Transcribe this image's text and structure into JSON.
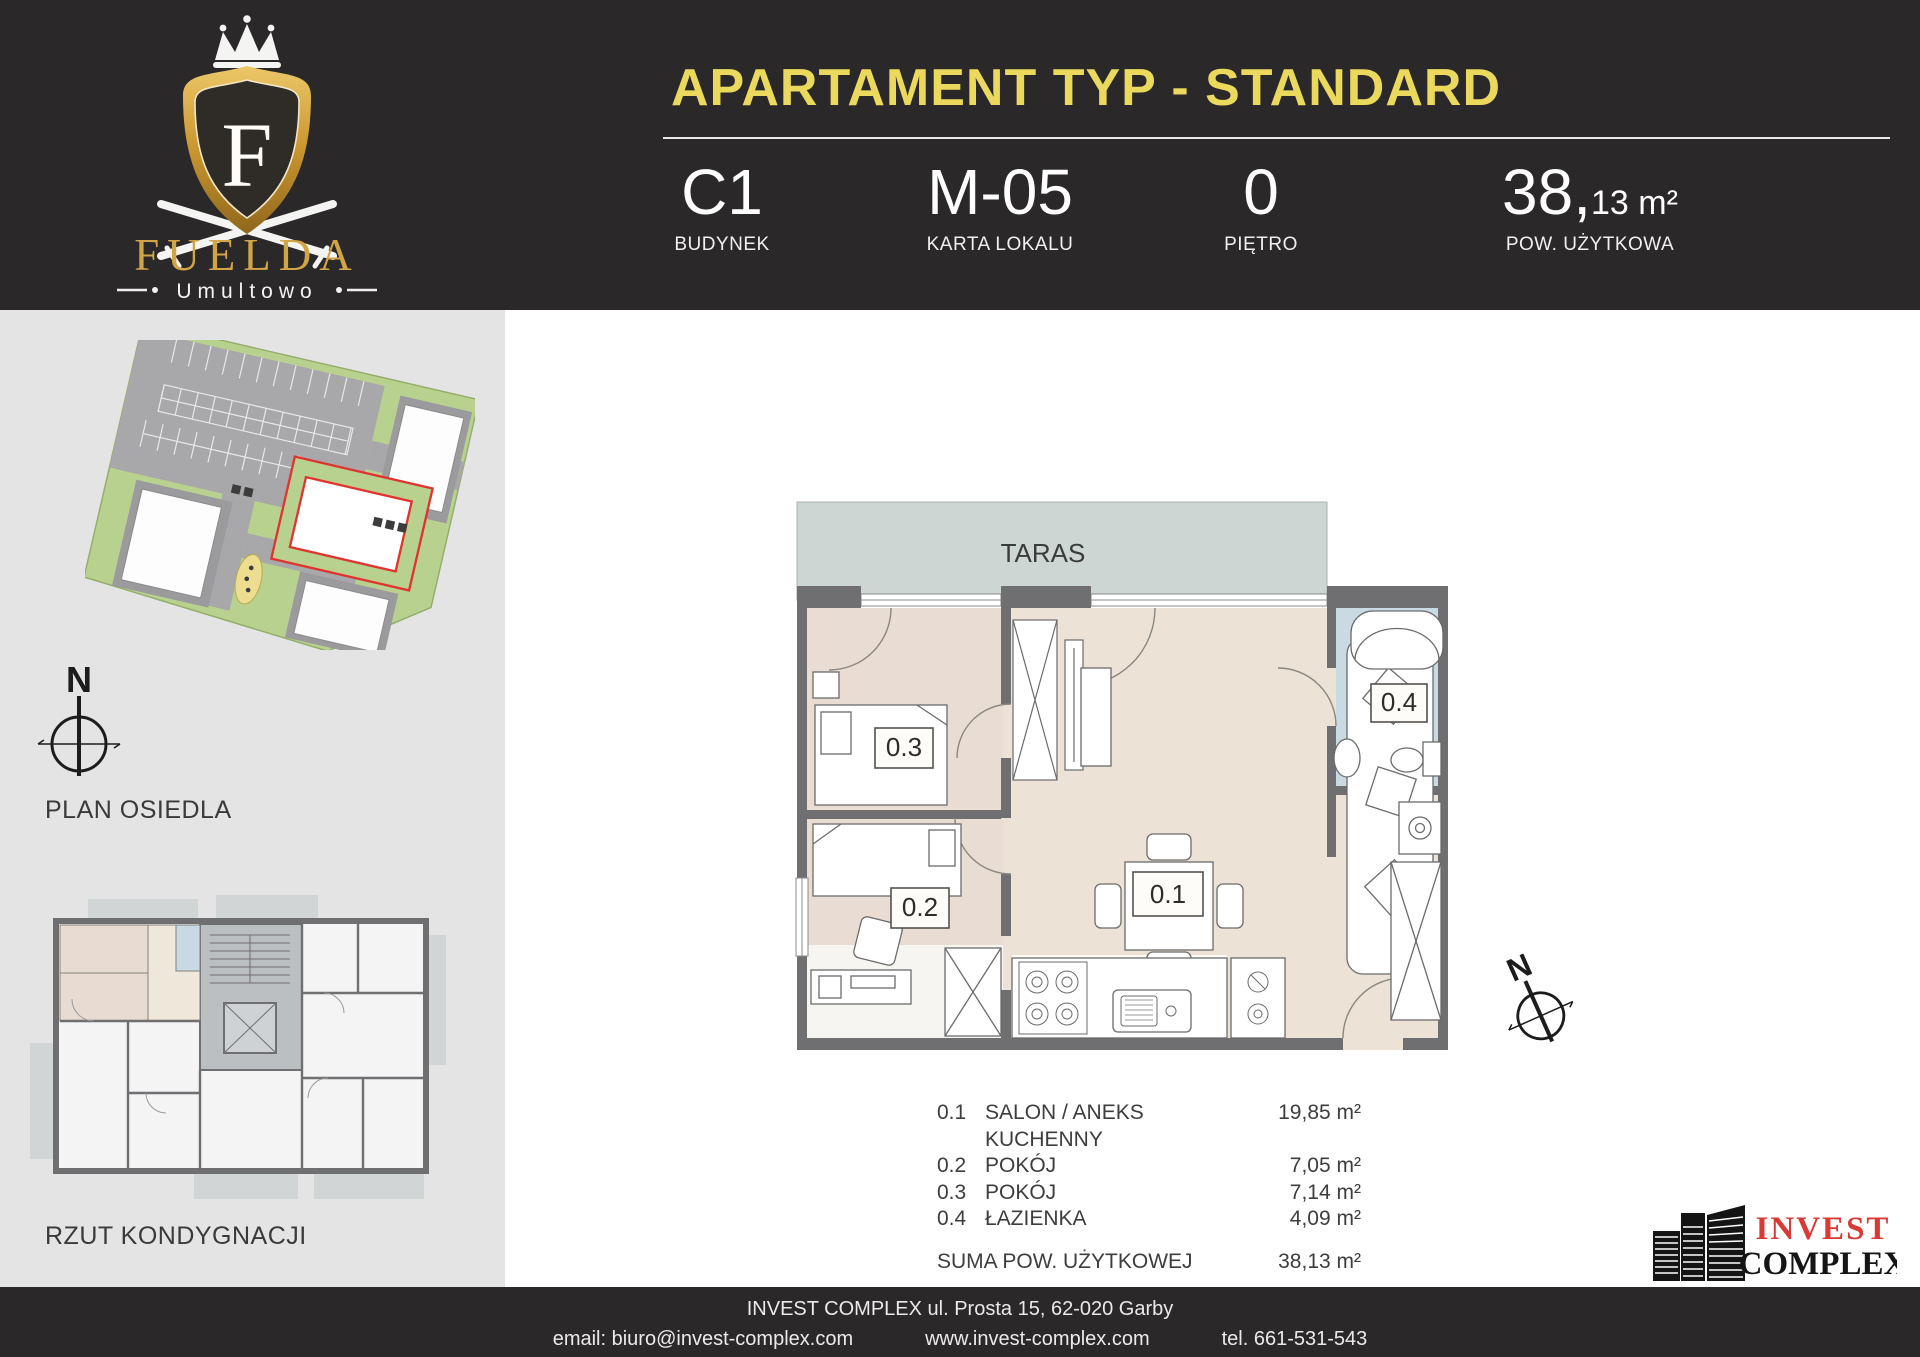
{
  "header": {
    "title": "APARTAMENT TYP - STANDARD",
    "logo": {
      "monogram": "F",
      "brand": "FUELDA",
      "location": "Umultowo"
    },
    "info": [
      {
        "value": "C1",
        "label": "BUDYNEK"
      },
      {
        "value": "M-05",
        "label": "KARTA LOKALU"
      },
      {
        "value": "0",
        "label": "PIĘTRO"
      },
      {
        "value_int": "38,",
        "value_dec": "13 m²",
        "label": "POW. UŻYTKOWA"
      }
    ]
  },
  "sidebar": {
    "site_plan_caption": "PLAN OSIEDLA",
    "floor_overview_caption": "RZUT KONDYGNACJI",
    "compass_label": "N"
  },
  "plan": {
    "terrace_label": "TARAS",
    "room_labels": {
      "salon": "0.1",
      "room2": "0.2",
      "room3": "0.3",
      "bath": "0.4"
    },
    "compass_label": "N"
  },
  "legend": {
    "rows": [
      {
        "no": "0.1",
        "name": "SALON / ANEKS KUCHENNY",
        "area": "19,85 m²"
      },
      {
        "no": "0.2",
        "name": "POKÓJ",
        "area": "7,05 m²"
      },
      {
        "no": "0.3",
        "name": "POKÓJ",
        "area": "7,14 m²"
      },
      {
        "no": "0.4",
        "name": "ŁAZIENKA",
        "area": "4,09 m²"
      }
    ],
    "total_label": "SUMA POW. UŻYTKOWEJ",
    "total_area": "38,13 m²"
  },
  "partner": {
    "name_top": "INVEST",
    "name_bottom": "COMPLEX"
  },
  "footer": {
    "address": "INVEST COMPLEX ul. Prosta 15, 62-020 Garby",
    "email": "email: biuro@invest-complex.com",
    "website": "www.invest-complex.com",
    "phone": "tel. 661-531-543"
  },
  "colors": {
    "header_bg": "#2b2829",
    "accent_yellow": "#ead95c",
    "sidebar_bg": "#e4e4e5",
    "wall": "#6f6e71",
    "room_beige": "#ece3d6",
    "room_rose": "#e9ddd3",
    "bath_blue": "#c9dae3",
    "terrace": "#cdd6d3",
    "site_green": "#b9d18f",
    "highlight_red": "#e0342f",
    "partner_red": "#d93a35",
    "gold": "#d2a445"
  }
}
